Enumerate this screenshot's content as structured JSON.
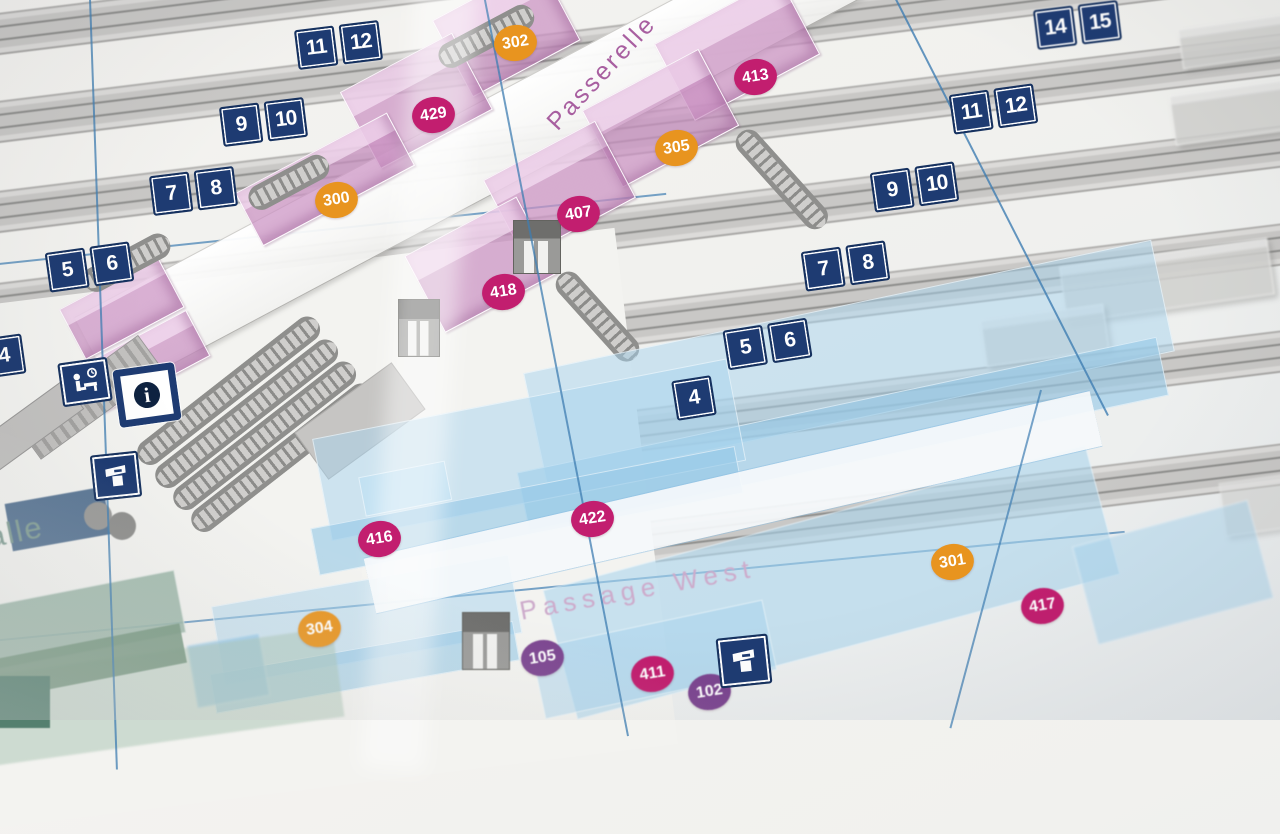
{
  "scene": {
    "description": "Printed railway-station plan photographed at an angle: platform tracks, a pink footbridge (Passerelle) with rooms, a blue underground passage (Passage West), numbered location markers and platform number signs."
  },
  "labels": {
    "bridge": "Passerelle",
    "passage": "Passage West",
    "hall_partial": "alle"
  },
  "platform_signs": {
    "left": [
      [
        "11",
        "12"
      ],
      [
        "9",
        "10"
      ],
      [
        "7",
        "8"
      ],
      [
        "5",
        "6"
      ],
      [
        "4"
      ]
    ],
    "right": [
      [
        "14",
        "15"
      ],
      [
        "11",
        "12"
      ],
      [
        "9",
        "10"
      ],
      [
        "7",
        "8"
      ],
      [
        "5",
        "6"
      ],
      [
        "4"
      ]
    ]
  },
  "location_markers": [
    {
      "label": "302",
      "type": "orange"
    },
    {
      "label": "429",
      "type": "magenta"
    },
    {
      "label": "413",
      "type": "magenta"
    },
    {
      "label": "305",
      "type": "orange"
    },
    {
      "label": "300",
      "type": "orange"
    },
    {
      "label": "407",
      "type": "magenta"
    },
    {
      "label": "418",
      "type": "magenta"
    },
    {
      "label": "422",
      "type": "magenta"
    },
    {
      "label": "416",
      "type": "magenta"
    },
    {
      "label": "301",
      "type": "orange"
    },
    {
      "label": "417",
      "type": "magenta"
    },
    {
      "label": "304",
      "type": "orange"
    },
    {
      "label": "105",
      "type": "purple"
    },
    {
      "label": "411",
      "type": "magenta"
    },
    {
      "label": "102",
      "type": "purple"
    }
  ],
  "icons": [
    {
      "name": "waiting-room-icon"
    },
    {
      "name": "information-icon",
      "glyph": "i"
    },
    {
      "name": "ticket-machine-icon"
    },
    {
      "name": "ticket-machine-icon"
    }
  ],
  "colors": {
    "sign_navy": "#1e3b72",
    "marker_orange": "#e8941f",
    "marker_magenta": "#c21e6f",
    "marker_purple": "#7c4590",
    "bridge_pink": "#cc92c3",
    "passage_blue": "#a9d2ea",
    "grid_line_blue": "#3f7db2",
    "track_gray": "#c8c7c5",
    "hall_green": "#9cb7a8"
  }
}
